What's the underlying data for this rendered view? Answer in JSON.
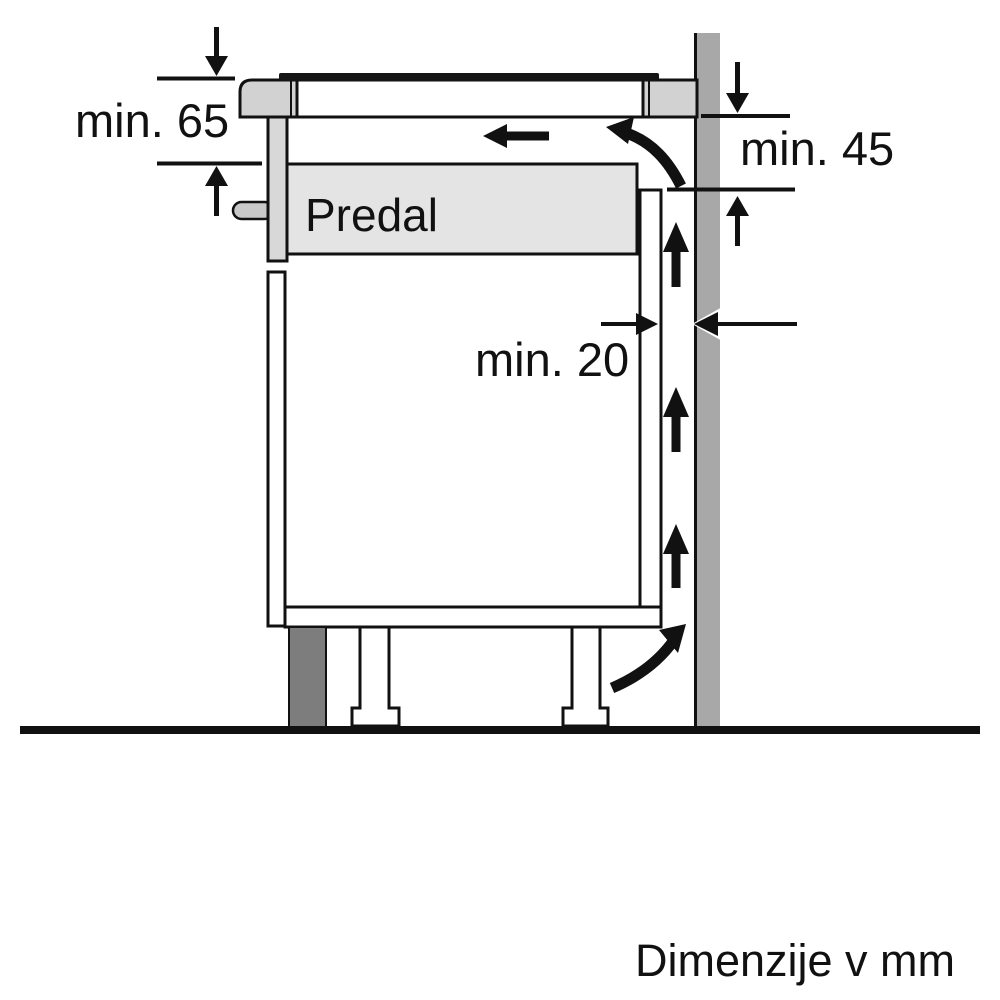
{
  "diagram": {
    "type": "appliance-installation-side-view",
    "drawer_label": "Predal",
    "dimensions": {
      "top_clearance": "min. 65",
      "rear_top_clearance": "min. 45",
      "wall_gap": "min. 20"
    },
    "footer_note": "Dimenzije v mm",
    "colors": {
      "worktop_gray": "#d2d2d2",
      "drawer_gray": "#e4e4e4",
      "front_gray": "#d8d8d8",
      "handle_gray": "#c9c9c9",
      "wall_gray": "#a8a8a8",
      "plinth_gray": "#7d7d7d",
      "line_black": "#111111"
    }
  }
}
